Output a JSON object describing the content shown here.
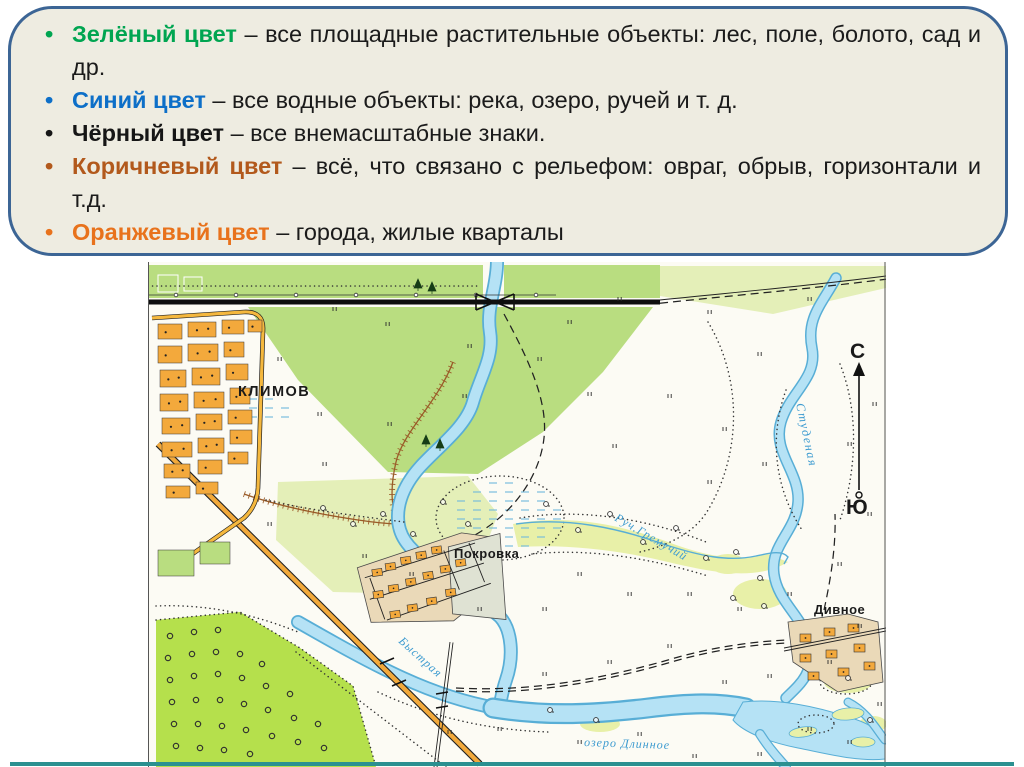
{
  "slide": {
    "legend": {
      "box_background": "#eeece1",
      "box_border_color": "#3c6595",
      "items": [
        {
          "term": "Зелёный цвет",
          "term_color": "#00a551",
          "desc": "– все площадные растительные объекты: лес, поле, болото, сад и др."
        },
        {
          "term": "Синий цвет",
          "term_color": "#0d6fc8",
          "desc": "– все водные объекты: река, озеро, ручей и т. д."
        },
        {
          "term": "Чёрный цвет",
          "term_color": "#161616",
          "desc": "– все внемасштабные знаки."
        },
        {
          "term": "Коричневый цвет",
          "term_color": "#b2591c",
          "desc": "– всё, что связано с рельефом: овраг, обрыв, горизонтали и т.д."
        },
        {
          "term": "Оранжевый цвет",
          "term_color": "#e8721c",
          "desc": "– города, жилые кварталы"
        }
      ]
    },
    "map": {
      "labels": {
        "town": "КЛИМОВ",
        "village_center": "Покровка",
        "village_east": "Дивное",
        "river_east": "Студеная",
        "stream": "Руч.Гремучий",
        "river_southwest": "Быстрая",
        "lake": "озеро Длинное",
        "compass_north": "С",
        "compass_south": "Ю"
      },
      "colors": {
        "forest_green": "#b9dd80",
        "orchard_green": "#b5e04c",
        "pale_green": "#e4efb8",
        "water_fill": "#b5e2f5",
        "water_outline": "#58aed6",
        "settlement_orange": "#f3a93c",
        "village_tan": "#ead9b8",
        "relief_brown": "#9a5b28",
        "water_label_blue": "#3d9bd0"
      }
    },
    "accent_bar_color": "#2b9090"
  }
}
